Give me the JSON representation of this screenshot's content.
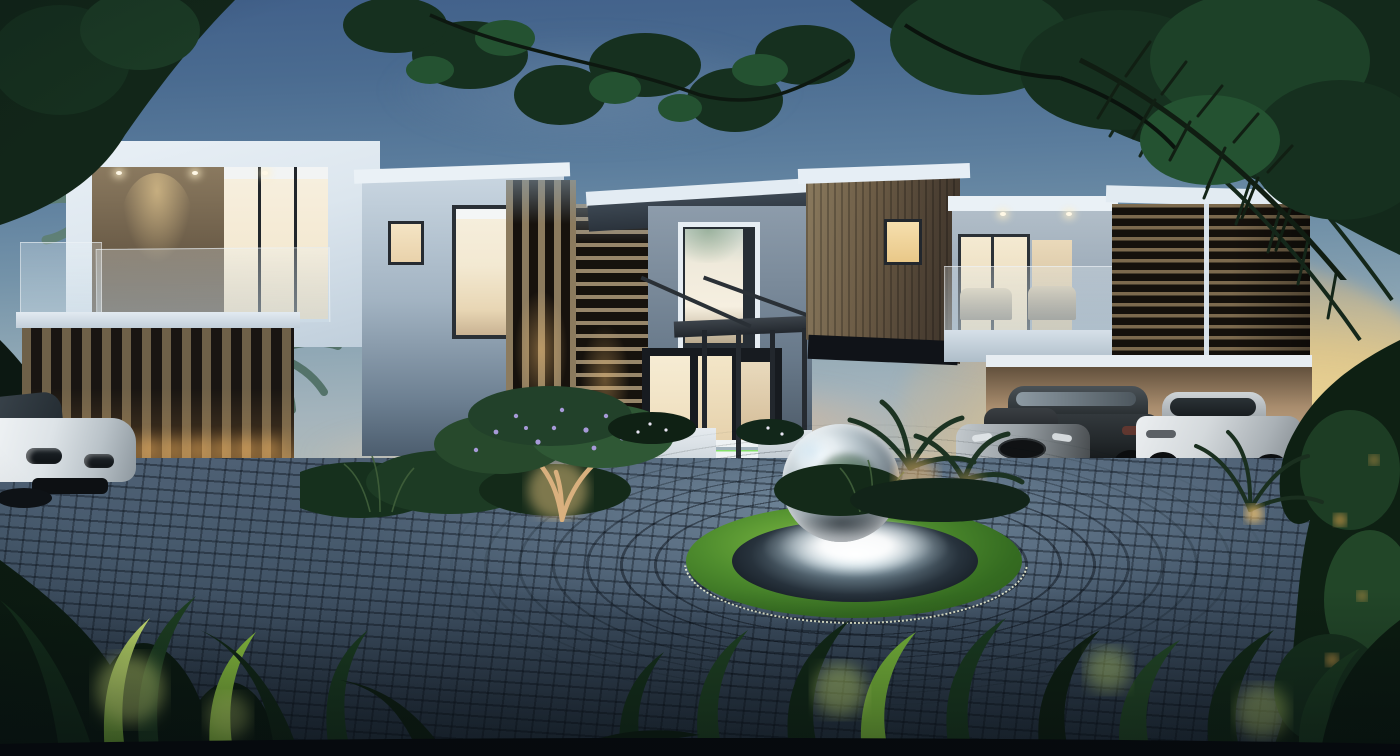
{
  "meta": {
    "title": "Modern villa at dusk — 3D architectural rendering",
    "aria_label": "Photorealistic dusk rendering of a modern two-storey white villa with timber slat screens, chrome sphere fountain on a circular cobblestone driveway, palm trees, tropical foreground foliage, a white SUV at left and three cars in an open carport at right"
  },
  "scene": {
    "time_of_day": "dusk",
    "objects": {
      "house": "two-storey modern villa, white render with timber cladding and louvre screens",
      "fountain": "mirror-polished sphere water feature in circular basin with grass ring",
      "driveway": "grey cobblestone pavers laid in concentric circles",
      "car_left": "white luxury SUV, front three-quarter view",
      "carport_cars": [
        "silver sports car",
        "dark grey SUV",
        "white coupe"
      ],
      "vegetation": [
        "overhanging tree canopy",
        "coconut palms",
        "palm fronds",
        "backlit tropical leaves",
        "uplit frangipani tree with purple blossoms"
      ]
    },
    "lighting": [
      "warm interior glow",
      "soffit downlights",
      "fence uplights",
      "green step LEDs",
      "garden uplights",
      "fountain ring light"
    ]
  },
  "palette": {
    "sky_top": "#41608a",
    "sky_mid": "#7493a9",
    "sunset_gold": "#f3d894",
    "cloud_peach": "#ecb98e",
    "wall_white": "#e3ecf3",
    "wall_shaded": "#8d9cab",
    "roof_dark": "#343f49",
    "timber": "#6b5b45",
    "louver_dark": "#15110c",
    "glass_warm": "#f5e9cd",
    "paver": "#46586b",
    "paver_joint": "#1f2a36",
    "grass": "#4f8d2e",
    "water_glow": "#f1f9fc",
    "sphere_chrome": "#b2bfc6",
    "carport_wall": "#b5987a",
    "foliage_dark": "#122619",
    "foliage_lit": "#9ed44c",
    "blossom": "#a79ad8"
  }
}
